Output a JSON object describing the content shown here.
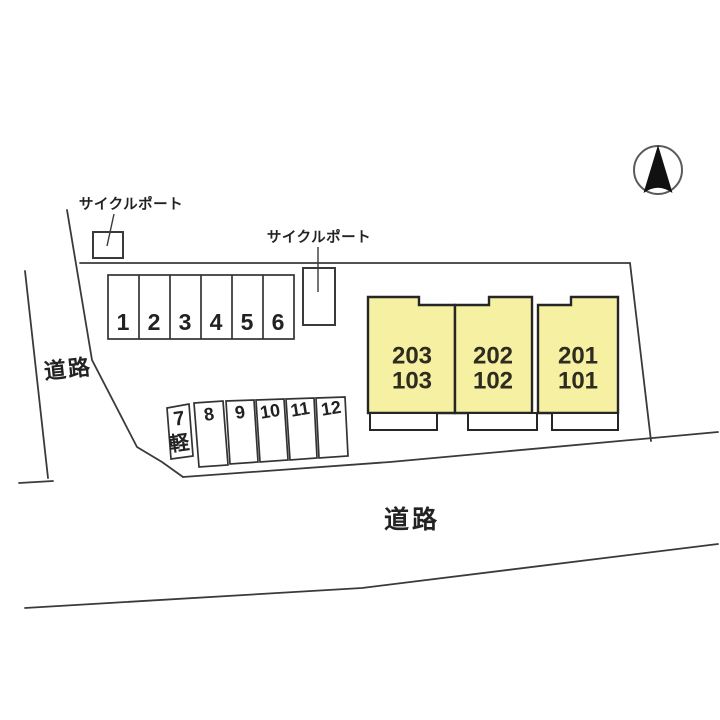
{
  "diagram": {
    "colors": {
      "building_fill": "#f5f0a2",
      "line": "#3a3a3a",
      "background": "#ffffff"
    },
    "labels": {
      "cycle_port_1": "サイクルポート",
      "cycle_port_2": "サイクルポート",
      "road_left": "道路",
      "road_bottom": "道路"
    },
    "buildings": [
      {
        "upper": "203",
        "lower": "103"
      },
      {
        "upper": "202",
        "lower": "102"
      },
      {
        "upper": "201",
        "lower": "101"
      }
    ],
    "parking_row1": [
      "1",
      "2",
      "3",
      "4",
      "5",
      "6"
    ],
    "parking_row2": {
      "kei_number": "7",
      "kei_label": "軽",
      "stalls": [
        "8",
        "9",
        "10",
        "11",
        "12"
      ]
    }
  }
}
